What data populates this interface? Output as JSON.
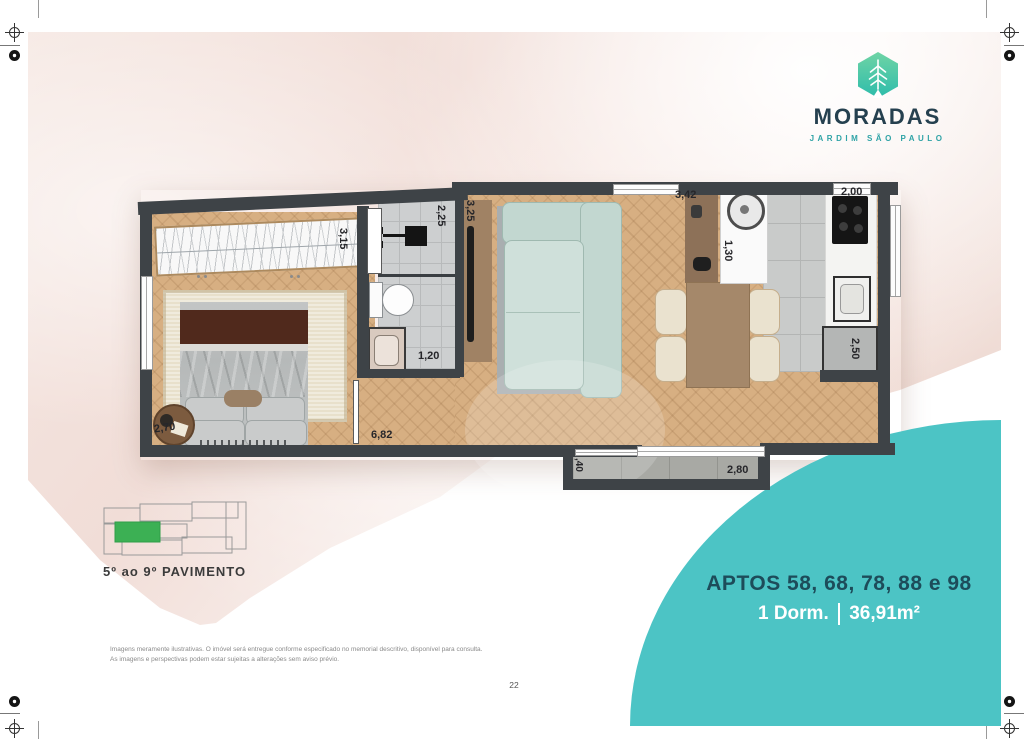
{
  "page": {
    "number": "22"
  },
  "brand": {
    "name": "MORADAS",
    "subtitle": "JARDIM SÃO PAULO",
    "icon": "leaf-hexagon-icon",
    "navy_color": "#25404f",
    "teal_color": "#2fa3a6"
  },
  "unit_panel": {
    "aptos_line": "APTOS 58, 68, 78, 88 e 98",
    "dorm": "1 Dorm.",
    "area": "36,91m²",
    "accent_color": "#4cc4c5",
    "title_color": "#1d4c5a"
  },
  "keyplan": {
    "label": "5º ao 9º PAVIMENTO",
    "highlight_color": "#3cb054"
  },
  "floorplan": {
    "wall_color": "#3e4347",
    "dims": [
      {
        "id": "bedroom-depth",
        "value": "3,15"
      },
      {
        "id": "bath-width",
        "value": "2,25"
      },
      {
        "id": "living-width",
        "value": "3,25"
      },
      {
        "id": "kitchen-living-length",
        "value": "3,42"
      },
      {
        "id": "kitchen-width",
        "value": "2,00"
      },
      {
        "id": "service-depth",
        "value": "1,30"
      },
      {
        "id": "bath-length",
        "value": "1,20"
      },
      {
        "id": "kitchen-depth",
        "value": "2,50"
      },
      {
        "id": "bedroom-width",
        "value": "2,70"
      },
      {
        "id": "internal-length",
        "value": "6,82"
      },
      {
        "id": "balcony-depth",
        "value": ",40"
      },
      {
        "id": "balcony-length",
        "value": "2,80"
      }
    ]
  },
  "disclaimer": {
    "line1": "Imagens meramente ilustrativas. O imóvel será entregue conforme especificado no memorial descritivo, disponível para consulta.",
    "line2": "As imagens e perspectivas podem estar sujeitas a alterações sem aviso prévio."
  }
}
